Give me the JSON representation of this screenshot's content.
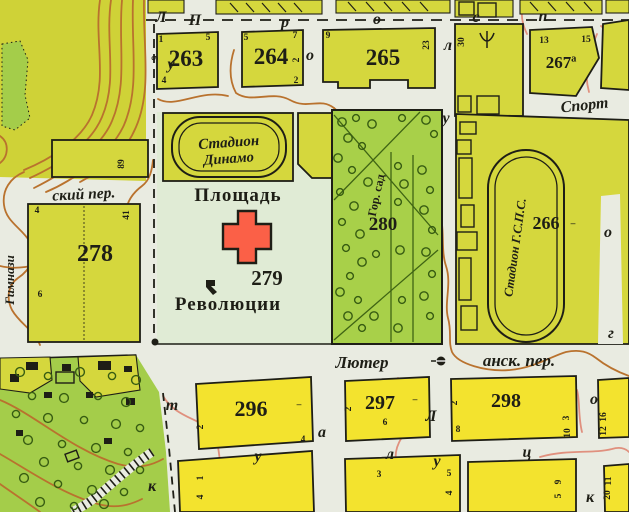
{
  "map": {
    "title": "city plan fragment with Revolution Square",
    "colors": {
      "street": "#e9ebe1",
      "terrain": "#cfd237",
      "olive": "#d5d73d",
      "yellow": "#f3e32e",
      "pale": "#e0ebd5",
      "park": "#a8d049",
      "grove": "#a4cd4a",
      "ink": "#1e1e16",
      "red": "#fb6047",
      "contour": "#b9722e",
      "contour-pink": "#e0907e",
      "tree": "#375c12",
      "parkline": "#3f6414"
    },
    "labels": {
      "blocks": [
        {
          "t": "263",
          "x": 186,
          "y": 66,
          "s": 23,
          "n": "block-number-263"
        },
        {
          "t": "264",
          "x": 271,
          "y": 64,
          "s": 23,
          "n": "block-number-264"
        },
        {
          "t": "265",
          "x": 383,
          "y": 65,
          "s": 23,
          "n": "block-number-265"
        },
        {
          "t": "267ª",
          "x": 561,
          "y": 68,
          "s": 17,
          "n": "block-number-267a"
        },
        {
          "t": "278",
          "x": 95,
          "y": 261,
          "s": 24,
          "n": "block-number-278"
        },
        {
          "t": "279",
          "x": 267,
          "y": 285,
          "s": 21,
          "n": "block-number-279"
        },
        {
          "t": "280",
          "x": 383,
          "y": 230,
          "s": 19,
          "n": "block-number-280"
        },
        {
          "t": "266",
          "x": 546,
          "y": 229,
          "s": 18,
          "n": "block-number-266"
        },
        {
          "t": "296",
          "x": 251,
          "y": 416,
          "s": 22,
          "n": "block-number-296"
        },
        {
          "t": "297",
          "x": 380,
          "y": 409,
          "s": 20,
          "n": "block-number-297"
        },
        {
          "t": "298",
          "x": 506,
          "y": 407,
          "s": 20,
          "n": "block-number-298"
        }
      ],
      "corners": [
        {
          "t": "1",
          "x": 161,
          "y": 42
        },
        {
          "t": "5",
          "x": 208,
          "y": 40
        },
        {
          "t": "9",
          "x": 158,
          "y": 58,
          "r": -90
        },
        {
          "t": "4",
          "x": 164,
          "y": 83
        },
        {
          "t": "5",
          "x": 246,
          "y": 40
        },
        {
          "t": "7",
          "x": 295,
          "y": 38
        },
        {
          "t": "2",
          "x": 299,
          "y": 60,
          "r": -90
        },
        {
          "t": "2",
          "x": 296,
          "y": 83
        },
        {
          "t": "9",
          "x": 328,
          "y": 38
        },
        {
          "t": "23",
          "x": 429,
          "y": 45,
          "r": -90
        },
        {
          "t": "30",
          "x": 464,
          "y": 42,
          "r": -90
        },
        {
          "t": "13",
          "x": 544,
          "y": 43
        },
        {
          "t": "15",
          "x": 586,
          "y": 42
        },
        {
          "t": "89",
          "x": 124,
          "y": 164,
          "r": -90
        },
        {
          "t": "4",
          "x": 37,
          "y": 213
        },
        {
          "t": "41",
          "x": 129,
          "y": 215,
          "r": -90
        },
        {
          "t": "6",
          "x": 40,
          "y": 297
        },
        {
          "t": "2",
          "x": 203,
          "y": 427,
          "r": -90
        },
        {
          "t": "4",
          "x": 303,
          "y": 442
        },
        {
          "t": "–",
          "x": 299,
          "y": 407
        },
        {
          "t": "2",
          "x": 351,
          "y": 409,
          "r": -90
        },
        {
          "t": "6",
          "x": 385,
          "y": 425
        },
        {
          "t": "–",
          "x": 415,
          "y": 402
        },
        {
          "t": "2",
          "x": 457,
          "y": 403,
          "r": -90
        },
        {
          "t": "8",
          "x": 458,
          "y": 432
        },
        {
          "t": "3",
          "x": 569,
          "y": 418,
          "r": -90
        },
        {
          "t": "10",
          "x": 570,
          "y": 433,
          "r": -90
        },
        {
          "t": "–",
          "x": 573,
          "y": 226
        },
        {
          "t": "16",
          "x": 606,
          "y": 417,
          "r": -90
        },
        {
          "t": "12",
          "x": 606,
          "y": 431,
          "r": -90
        },
        {
          "t": "1",
          "x": 203,
          "y": 478,
          "r": -90
        },
        {
          "t": "4",
          "x": 203,
          "y": 497,
          "r": -90
        },
        {
          "t": "3",
          "x": 379,
          "y": 477
        },
        {
          "t": "5",
          "x": 449,
          "y": 476
        },
        {
          "t": "4",
          "x": 452,
          "y": 493,
          "r": -90
        },
        {
          "t": "9",
          "x": 561,
          "y": 482,
          "r": -90
        },
        {
          "t": "5",
          "x": 561,
          "y": 496,
          "r": -90
        },
        {
          "t": "11",
          "x": 611,
          "y": 481,
          "r": -90
        },
        {
          "t": "20",
          "x": 610,
          "y": 495,
          "r": -90
        }
      ],
      "letters": [
        {
          "t": "П",
          "x": 195,
          "y": 25
        },
        {
          "t": "р",
          "x": 285,
          "y": 27
        },
        {
          "t": "о",
          "x": 377,
          "y": 24
        },
        {
          "t": "с",
          "x": 476,
          "y": 22
        },
        {
          "t": "п",
          "x": 543,
          "y": 21
        },
        {
          "t": "Л",
          "x": 161,
          "y": 22
        },
        {
          "t": "у",
          "x": 171,
          "y": 69
        },
        {
          "t": "о",
          "x": 310,
          "y": 60
        },
        {
          "t": "л",
          "x": 448,
          "y": 50
        },
        {
          "t": "у",
          "x": 446,
          "y": 123
        },
        {
          "t": "о",
          "x": 608,
          "y": 237
        },
        {
          "t": "г",
          "x": 611,
          "y": 338
        },
        {
          "t": "т",
          "x": 172,
          "y": 410
        },
        {
          "t": "к",
          "x": 152,
          "y": 491
        },
        {
          "t": "у",
          "x": 258,
          "y": 461
        },
        {
          "t": "а",
          "x": 322,
          "y": 437
        },
        {
          "t": "л",
          "x": 390,
          "y": 459
        },
        {
          "t": "Л",
          "x": 431,
          "y": 421
        },
        {
          "t": "у",
          "x": 437,
          "y": 466
        },
        {
          "t": "ц",
          "x": 527,
          "y": 457
        },
        {
          "t": "о",
          "x": 594,
          "y": 404
        },
        {
          "t": "к",
          "x": 590,
          "y": 502
        }
      ],
      "streets": [
        {
          "t": "ский пер.",
          "x": 84,
          "y": 199,
          "s": 15.5,
          "r": -3,
          "n": "street-name-skiy-per"
        },
        {
          "t": "Лютер",
          "x": 362,
          "y": 368,
          "s": 17,
          "n": "street-name-lyuter"
        },
        {
          "t": "анск. пер.",
          "x": 519,
          "y": 366,
          "s": 17,
          "n": "street-name-ansk-per"
        },
        {
          "t": "Спорт",
          "x": 585,
          "y": 110,
          "s": 16,
          "r": -6,
          "w": "bold",
          "n": "street-name-sport"
        },
        {
          "t": "Гимнази",
          "x": 14,
          "y": 280,
          "s": 13,
          "r": -90,
          "n": "street-name-gimnazi"
        }
      ],
      "places": [
        {
          "t": "Площадь",
          "x": 238,
          "y": 201,
          "s": 19,
          "w": "600",
          "ls": 1,
          "n": "label-ploshchad"
        },
        {
          "t": "Революции",
          "x": 228,
          "y": 310,
          "s": 19,
          "w": "600",
          "ls": 1,
          "n": "label-revolyutsii"
        },
        {
          "t": "Стадион",
          "x": 229,
          "y": 147,
          "s": 15,
          "i": true,
          "w": "bold",
          "r": -4,
          "n": "label-stadion-dinamo-1"
        },
        {
          "t": "Динамо",
          "x": 229,
          "y": 163,
          "s": 14.5,
          "i": true,
          "w": "bold",
          "r": -4,
          "n": "label-stadion-dinamo-2"
        },
        {
          "t": "Стадион Г.С.П.С.",
          "x": 519,
          "y": 248,
          "s": 12.5,
          "i": true,
          "w": "bold",
          "r": -82,
          "n": "label-stadion-gsps"
        },
        {
          "t": "Гор. сад",
          "x": 380,
          "y": 196,
          "s": 12,
          "w": "bold",
          "r": -78,
          "n": "label-gor-sad"
        }
      ]
    },
    "park_trees": [
      [
        342,
        122
      ],
      [
        356,
        118
      ],
      [
        372,
        124
      ],
      [
        402,
        118
      ],
      [
        426,
        120
      ],
      [
        434,
        134
      ],
      [
        348,
        138
      ],
      [
        362,
        146
      ],
      [
        338,
        158
      ],
      [
        352,
        170
      ],
      [
        368,
        182
      ],
      [
        340,
        192
      ],
      [
        354,
        206
      ],
      [
        342,
        222
      ],
      [
        360,
        234
      ],
      [
        346,
        248
      ],
      [
        362,
        262
      ],
      [
        350,
        276
      ],
      [
        340,
        292
      ],
      [
        358,
        300
      ],
      [
        348,
        316
      ],
      [
        362,
        328
      ],
      [
        374,
        316
      ],
      [
        398,
        166
      ],
      [
        404,
        184
      ],
      [
        398,
        202
      ],
      [
        422,
        170
      ],
      [
        430,
        190
      ],
      [
        424,
        210
      ],
      [
        432,
        230
      ],
      [
        426,
        252
      ],
      [
        432,
        274
      ],
      [
        424,
        296
      ],
      [
        430,
        316
      ],
      [
        400,
        250
      ],
      [
        402,
        300
      ],
      [
        398,
        328
      ],
      [
        376,
        254
      ]
    ],
    "grove_trees": [
      [
        20,
        372
      ],
      [
        48,
        376
      ],
      [
        80,
        372
      ],
      [
        112,
        376
      ],
      [
        136,
        380
      ],
      [
        32,
        396
      ],
      [
        64,
        398
      ],
      [
        98,
        396
      ],
      [
        126,
        402
      ],
      [
        16,
        414
      ],
      [
        48,
        418
      ],
      [
        84,
        420
      ],
      [
        116,
        424
      ],
      [
        140,
        428
      ],
      [
        28,
        440
      ],
      [
        62,
        444
      ],
      [
        96,
        448
      ],
      [
        128,
        452
      ],
      [
        44,
        462
      ],
      [
        78,
        466
      ],
      [
        110,
        470
      ],
      [
        140,
        470
      ],
      [
        24,
        478
      ],
      [
        58,
        484
      ],
      [
        92,
        490
      ],
      [
        124,
        492
      ],
      [
        40,
        502
      ],
      [
        74,
        506
      ],
      [
        104,
        504
      ]
    ]
  }
}
